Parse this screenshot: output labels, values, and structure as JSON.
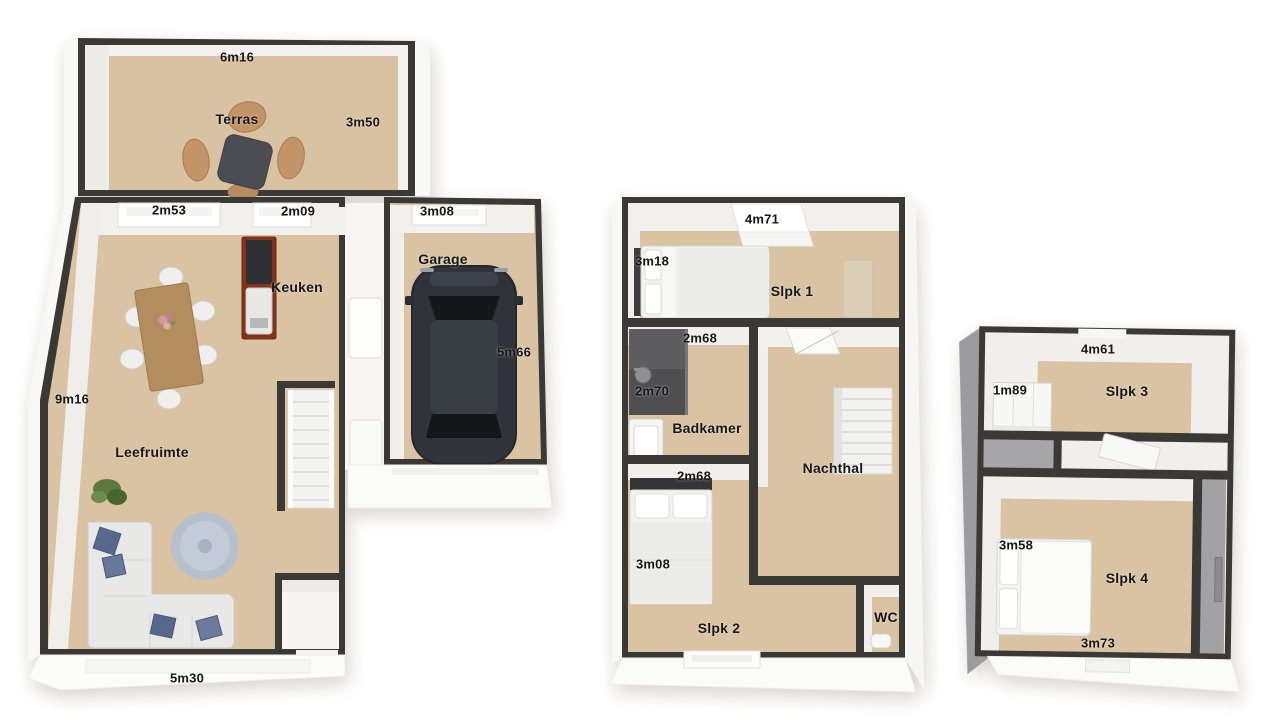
{
  "document": {
    "type": "3D floor plan, three levels"
  },
  "colors": {
    "background": "#ffffff",
    "wall": "#3b3936",
    "floor": "#d9c3a2",
    "inner_wall_face": "#f1f0ed",
    "roof_gray": "#9c9c9e",
    "kitchen_counter": "#84331b",
    "car_body": "#30333a",
    "rug": "#b6c0cd",
    "pillow_blue": "#56688c",
    "chair_tan": "#c29468",
    "table_wood": "#b28e5e"
  },
  "floors": {
    "ground": {
      "rooms": {
        "terras": "Terras",
        "keuken": "Keuken",
        "garage": "Garage",
        "leefruimte": "Leefruimte"
      },
      "dimensions": {
        "terras_width": "6m16",
        "terras_depth": "3m50",
        "window_left": "2m53",
        "window_right": "2m09",
        "garage_width": "3m08",
        "garage_depth": "5m66",
        "living_depth": "9m16",
        "living_width": "5m30"
      }
    },
    "first": {
      "rooms": {
        "slpk1": "Slpk 1",
        "badkamer": "Badkamer",
        "nachthal": "Nachthal",
        "slpk2": "Slpk 2",
        "wc": "WC"
      },
      "dimensions": {
        "width_top": "4m71",
        "slpk1_depth": "3m18",
        "badkamer_width": "2m68",
        "badkamer_depth": "2m70",
        "slpk2_width": "2m68",
        "slpk2_depth": "3m08"
      }
    },
    "second": {
      "rooms": {
        "slpk3": "Slpk 3",
        "slpk4": "Slpk 4"
      },
      "dimensions": {
        "width_top": "4m61",
        "closet_width": "1m89",
        "slpk4_depth": "3m58",
        "slpk4_width": "3m73"
      }
    }
  }
}
